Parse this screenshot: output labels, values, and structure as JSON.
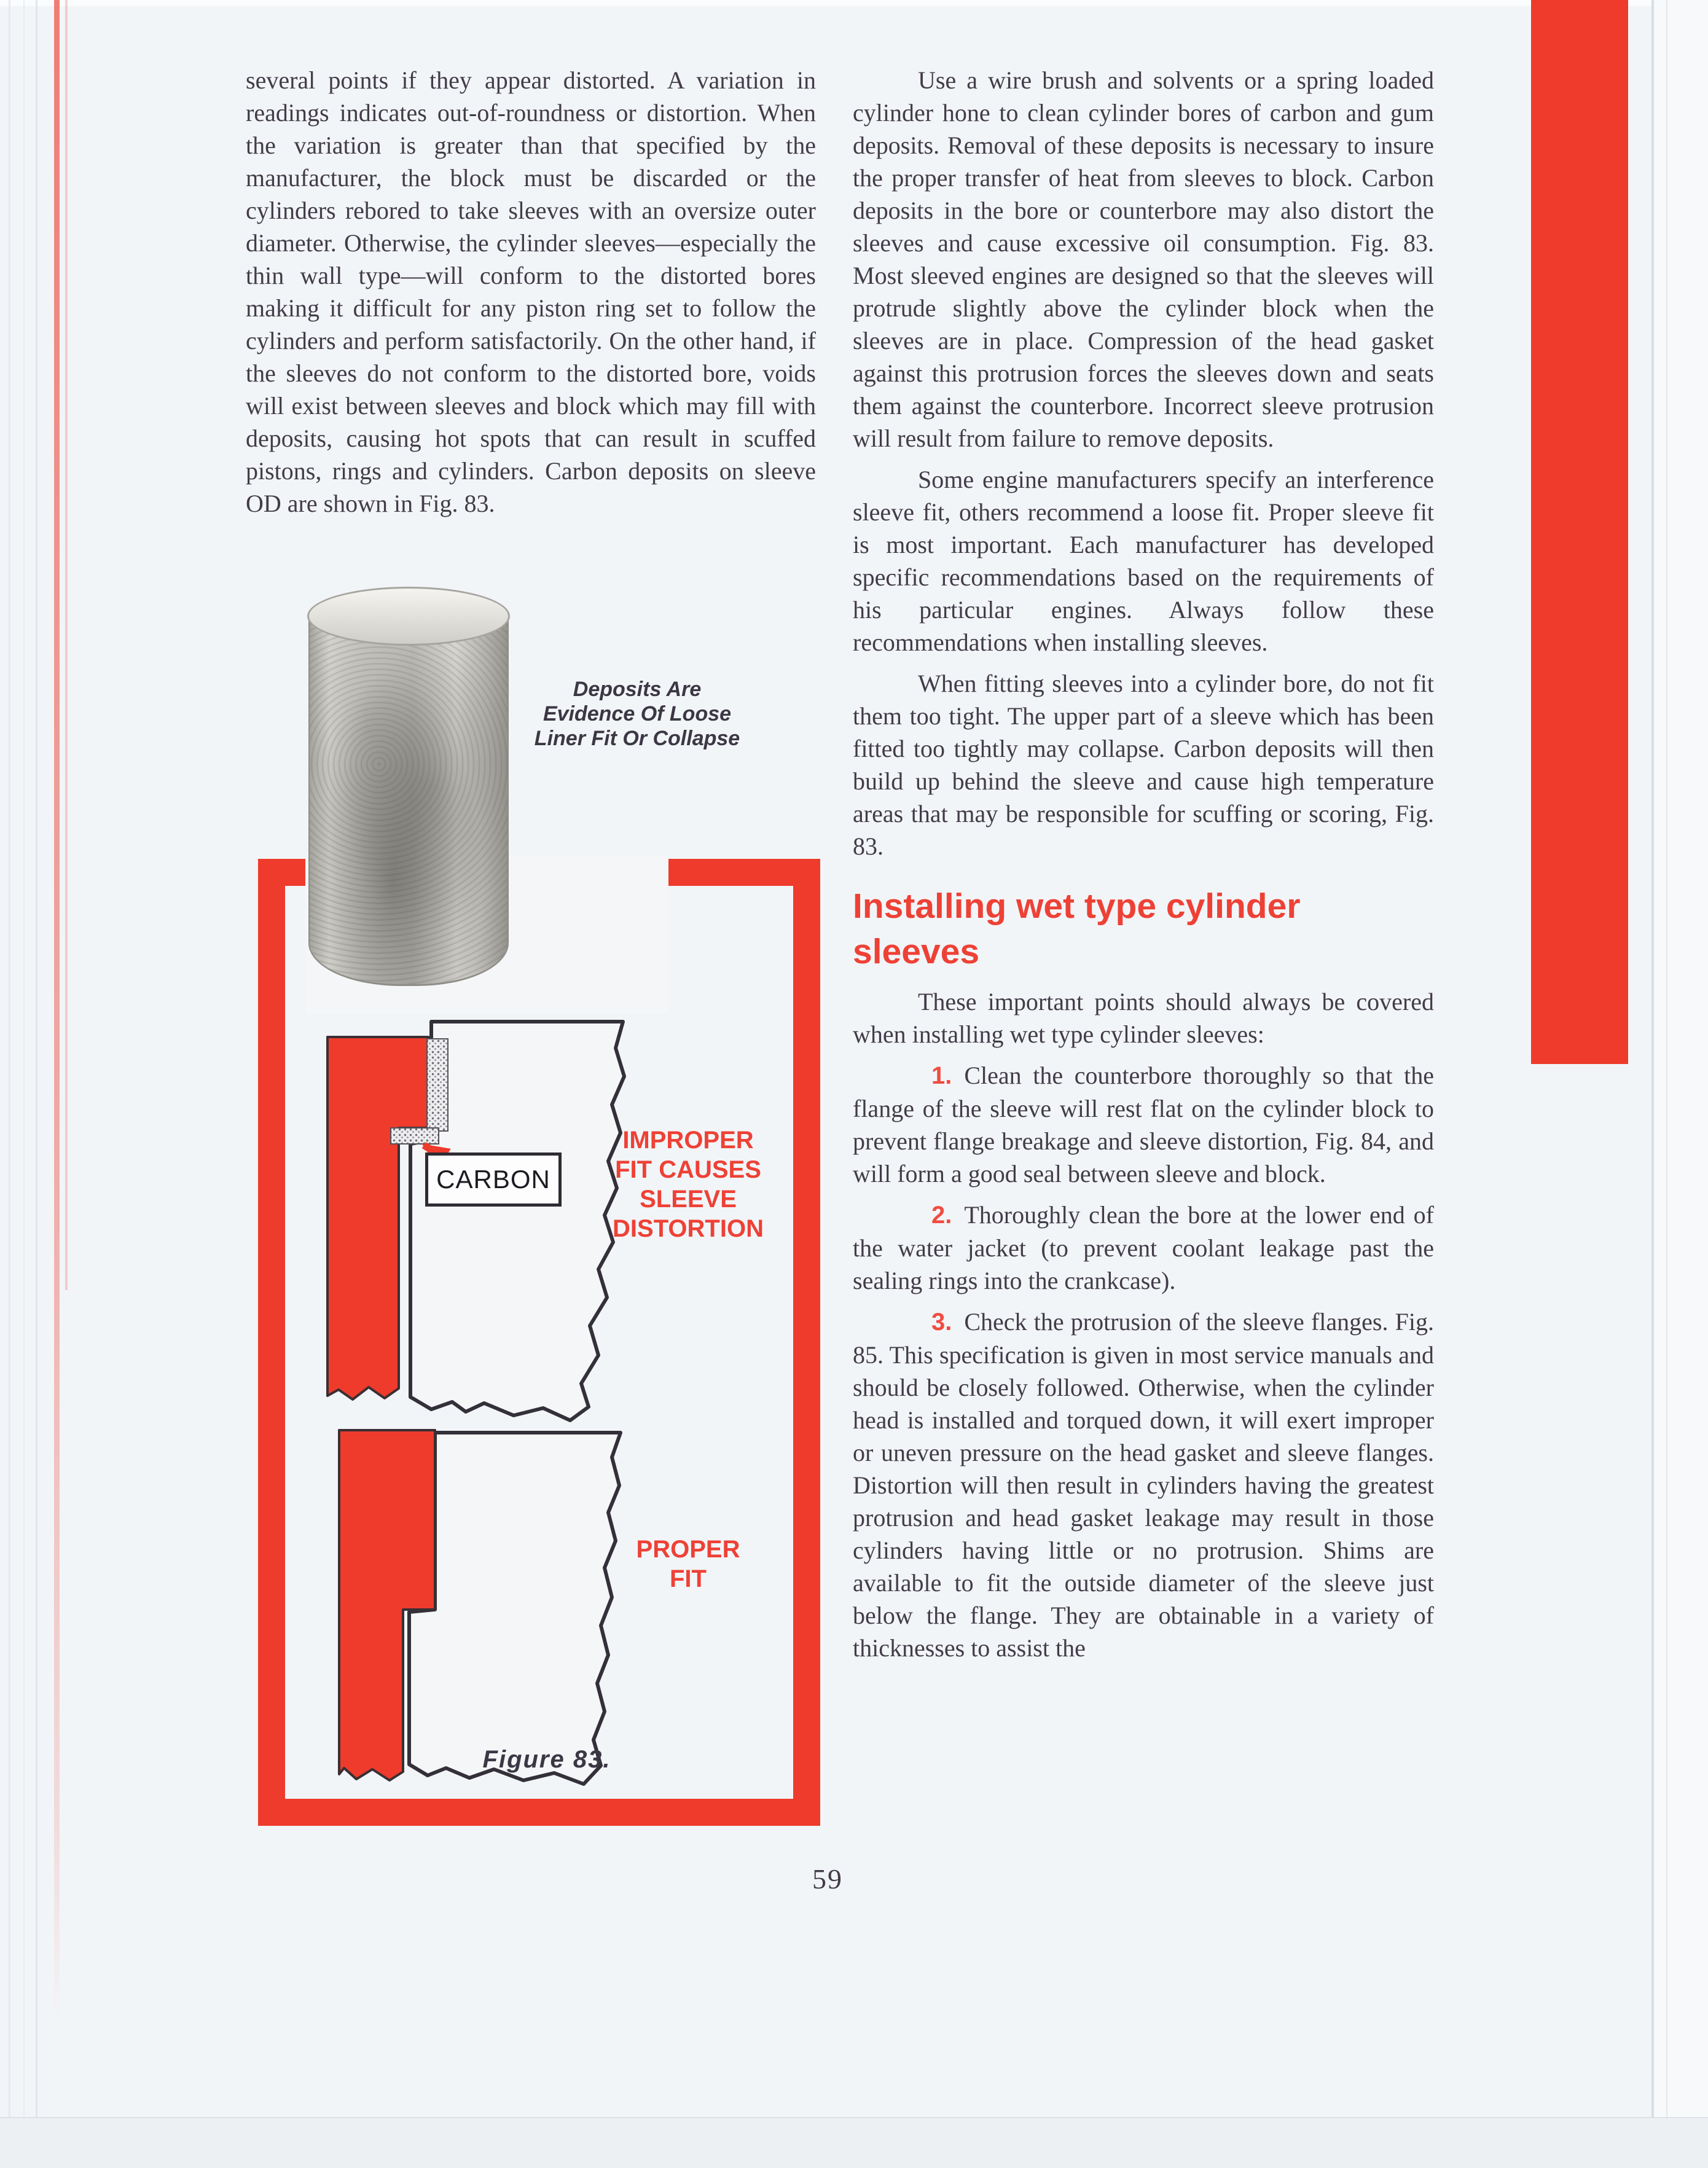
{
  "page_number": "59",
  "left_column": {
    "paragraph": "several points if they appear distorted. A variation in readings indicates out-of-roundness or distortion. When the variation is greater than that specified by the manufacturer, the block must be discarded or the cylinders rebored to take sleeves with an oversize outer diameter. Otherwise, the cylinder sleeves—especially the thin wall type—will conform to the distorted bores making it difficult for any piston ring set to follow the cylinders and perform satisfactorily. On the other hand, if the sleeves do not conform to the distorted bore, voids will exist between sleeves and block which may fill with deposits, causing hot spots that can result in scuffed pistons, rings and cylinders. Carbon deposits on sleeve OD are shown in Fig. 83."
  },
  "right_column": {
    "paragraphs": [
      "Use a wire brush and solvents or a spring loaded cylinder hone to clean cylinder bores of carbon and gum deposits. Removal of these deposits is necessary to insure the proper transfer of heat from sleeves to block. Carbon deposits in the bore or counterbore may also distort the sleeves and cause excessive oil consumption. Fig. 83. Most sleeved engines are designed so that the sleeves will protrude slightly above the cylinder block when the sleeves are in place. Compression of the head gasket against this protrusion forces the sleeves down and seats them against the counterbore. Incorrect sleeve protrusion will result from failure to remove deposits.",
      "Some engine manufacturers specify an interference sleeve fit, others recommend a loose fit. Proper sleeve fit is most important. Each manufacturer has developed specific recommendations based on the requirements of his particular engines. Always follow these recommendations when installing sleeves.",
      "When fitting sleeves into a cylinder bore, do not fit them too tight. The upper part of a sleeve which has been fitted too tightly may collapse. Carbon deposits will then build up behind the sleeve and cause high temperature areas that may be responsible for scuffing or scoring, Fig. 83."
    ],
    "heading": "Installing wet type cylinder sleeves",
    "intro": "These important points should always be covered when installing wet type cylinder sleeves:",
    "steps": [
      {
        "num": "1.",
        "text": "Clean the counterbore thoroughly so that the flange of the sleeve will rest flat on the cylinder block to prevent flange breakage and sleeve distortion, Fig. 84, and will form a good seal between sleeve and block."
      },
      {
        "num": "2.",
        "text": "Thoroughly clean the bore at the lower end of the water jacket (to prevent coolant leakage past the sealing rings into the crankcase)."
      },
      {
        "num": "3.",
        "text": "Check the protrusion of the sleeve flanges. Fig. 85. This specification is given in most service manuals and should be closely followed. Otherwise, when the cylinder head is installed and torqued down, it will exert improper or uneven pressure on the head gasket and sleeve flanges. Distortion will then result in cylinders having the greatest protrusion and head gasket leakage may result in those cylinders having little or no protrusion. Shims are available to fit the outside diameter of the sleeve just below the flange. They are obtainable in a variety of thicknesses to assist the"
      }
    ]
  },
  "figure": {
    "photo_caption": "Deposits Are Evidence Of Loose Liner Fit Or Collapse",
    "carbon_label": "CARBON",
    "improper_label": "IMPROPER FIT CAUSES SLEEVE DISTORTION",
    "proper_label": "PROPER FIT",
    "caption": "Figure 83."
  },
  "colors": {
    "accent_red": "#ee3b2c",
    "body_text": "#423c48",
    "paper": "#f2f5f8"
  }
}
